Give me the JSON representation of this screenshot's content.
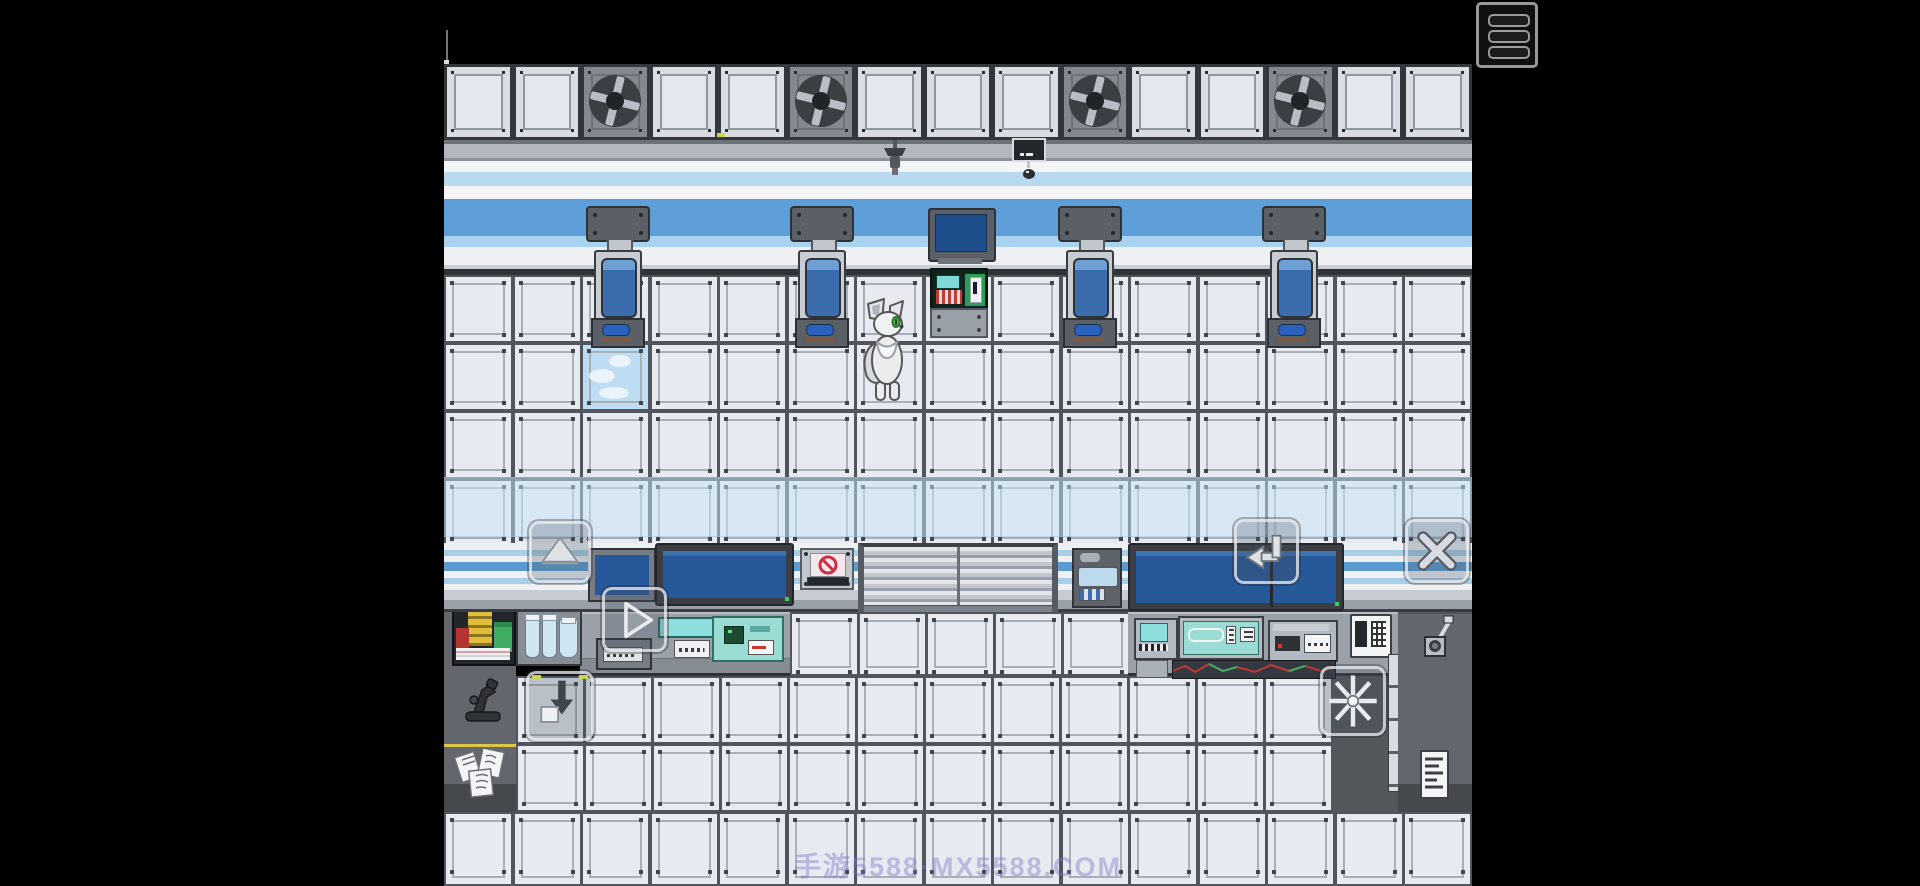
{
  "watermark": {
    "text": "手游5588·MX5588.COM"
  },
  "colors": {
    "black": "#000000",
    "tile_face": "#e7eaf0",
    "tile_border": "#51555d",
    "tile_inner": "#a9afb9",
    "ceil_face": "#d9dde3",
    "fan_face": "#85898f",
    "blue_band": "#5f9fd9",
    "blue_light": "#b8d9f0",
    "screen": "#27589a",
    "teal": "#8fdede",
    "counter": "#9ba1a9",
    "column": "#63676d",
    "red": "#b23530",
    "green": "#3fae62",
    "yellow": "#e0be3c",
    "glass": "#cfe6f2",
    "wm": "rgba(122,116,196,0.42)"
  },
  "hud": {
    "menu_button": {
      "name": "menu-button",
      "icon": "hamburger-menu-icon"
    },
    "touch_buttons": [
      {
        "name": "up-button",
        "icon": "arrow-up-icon",
        "x": 529,
        "y": 521,
        "w": 62,
        "h": 62
      },
      {
        "name": "forward-button",
        "icon": "arrow-right-icon",
        "x": 602,
        "y": 587,
        "w": 65,
        "h": 65
      },
      {
        "name": "enter-button",
        "icon": "enter-return-icon",
        "x": 1234,
        "y": 519,
        "w": 65,
        "h": 65
      },
      {
        "name": "close-button",
        "icon": "close-x-icon",
        "x": 1405,
        "y": 519,
        "w": 64,
        "h": 64
      },
      {
        "name": "item-drop-button",
        "icon": "arrow-down-box-icon",
        "x": 526,
        "y": 671,
        "w": 68,
        "h": 70
      },
      {
        "name": "spark-button",
        "icon": "spark-icon",
        "x": 1320,
        "y": 666,
        "w": 66,
        "h": 70
      }
    ]
  },
  "icons": {
    "hamburger-menu-icon": "≡",
    "arrow-up-icon": "▲",
    "arrow-right-icon": "▶",
    "enter-return-icon": "↵",
    "close-x-icon": "✕",
    "arrow-down-box-icon": "⬇",
    "spark-icon": "✳",
    "no-entry-icon": "🚫"
  },
  "scene": {
    "ceiling": {
      "tile_count": 15,
      "fan_tiles": [
        2,
        5,
        9,
        12
      ]
    },
    "wall_grid": {
      "cols": 15,
      "rows": 4,
      "top": 275,
      "row_h": 68,
      "sky_tile": {
        "col": 2,
        "row": 1
      }
    },
    "hanging_machines": {
      "xs": [
        142,
        346,
        614,
        818
      ],
      "y": 206
    },
    "floor_regions": [
      {
        "x": 346,
        "y": 612,
        "cols": 5,
        "rows": 1,
        "tw": 68,
        "th": 64
      },
      {
        "x": 72,
        "y": 676,
        "cols": 12,
        "rows": 2,
        "tw": 68,
        "th": 68
      },
      {
        "x": 0,
        "y": 812,
        "cols": 15,
        "rows": 1,
        "tw": 68.5333,
        "th": 74
      }
    ],
    "character": {
      "name": "white-wolf-character"
    }
  }
}
